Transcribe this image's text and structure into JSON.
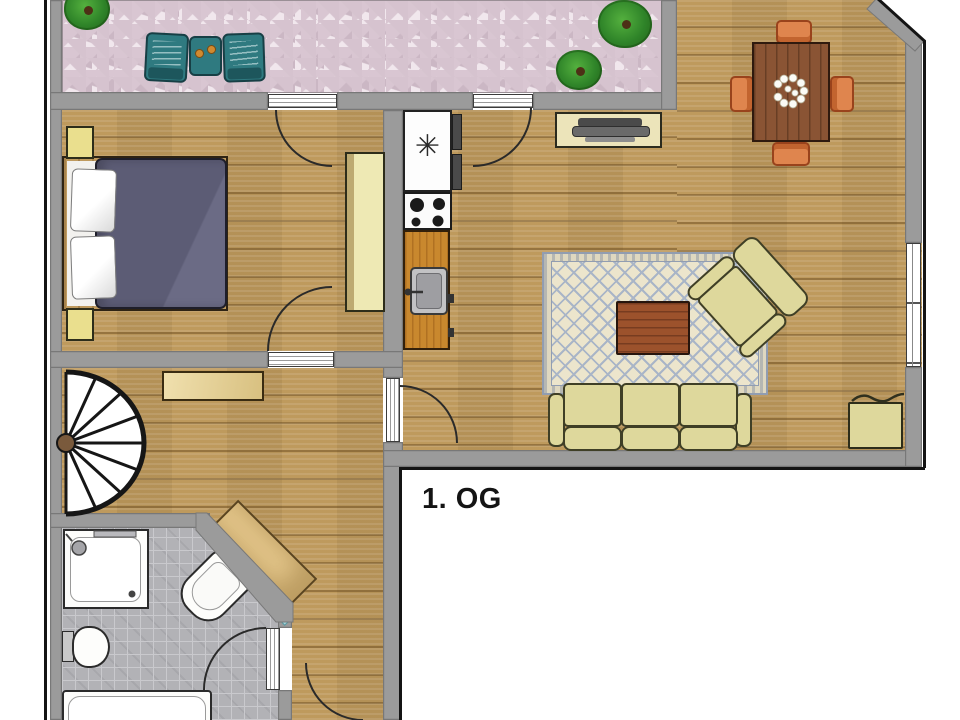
{
  "floor_plan": {
    "floor_label": "1. OG",
    "kitchen": {
      "freezer_symbol": "✳"
    },
    "colors": {
      "wall_gray": "#9b9b9b",
      "outline_black": "#141414",
      "wood_floor": "#c6a263",
      "terrace_stone": "#f1e7ed",
      "bathroom_tile": "#b2b2b6",
      "kitchen_counter": "#c9882e",
      "upholstery_cream": "#ded89c",
      "bed_duvet": "#5e5e77",
      "dining_table_brown": "#8a5434",
      "dining_chair_orange": "#df854e",
      "terrace_chair_teal": "#2f7a80",
      "rug_cream": "#ece5cc",
      "rug_lattice_blue": "#a9b5c7",
      "mirror_cyan": "#c2e8ec",
      "plant_green": "#2f8429"
    }
  }
}
